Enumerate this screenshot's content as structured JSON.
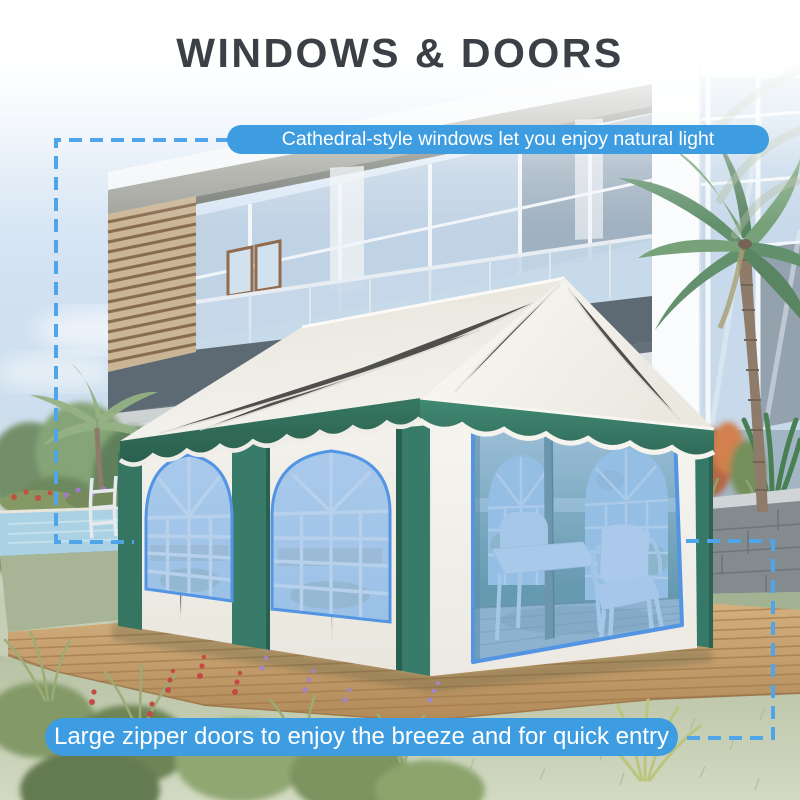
{
  "title": "WINDOWS & DOORS",
  "callouts": {
    "windows": "Cathedral-style windows let you enjoy natural light",
    "doors": "Large zipper doors to enjoy the breeze and for quick entry"
  },
  "colors": {
    "callout_background": "#3E9CE1",
    "connector_dash": "#4FA5E8",
    "feature_highlight": "#4A8FE2",
    "tent_green": "#2E7561",
    "title_text": "#3B4047"
  }
}
